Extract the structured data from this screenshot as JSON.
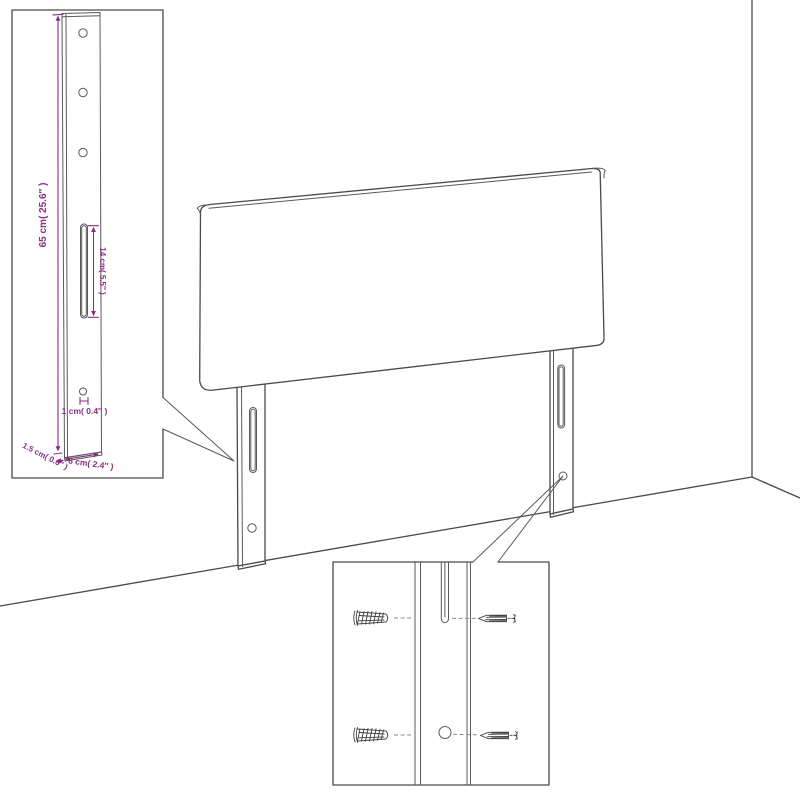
{
  "insets": {
    "leg_detail": {
      "height_label": "65 cm( 25.6″ )",
      "slot_label": "14 cm( 5.5″ )",
      "hole_label": "1 cm( 0.4″ )",
      "thickness_label": "1.5 cm( 0.6″ )",
      "width_label": "6 cm( 2.4″ )"
    }
  },
  "colors": {
    "dimension_text": "#8B2E80",
    "line_art": "#4A4A4A",
    "background": "#FFFFFF"
  }
}
